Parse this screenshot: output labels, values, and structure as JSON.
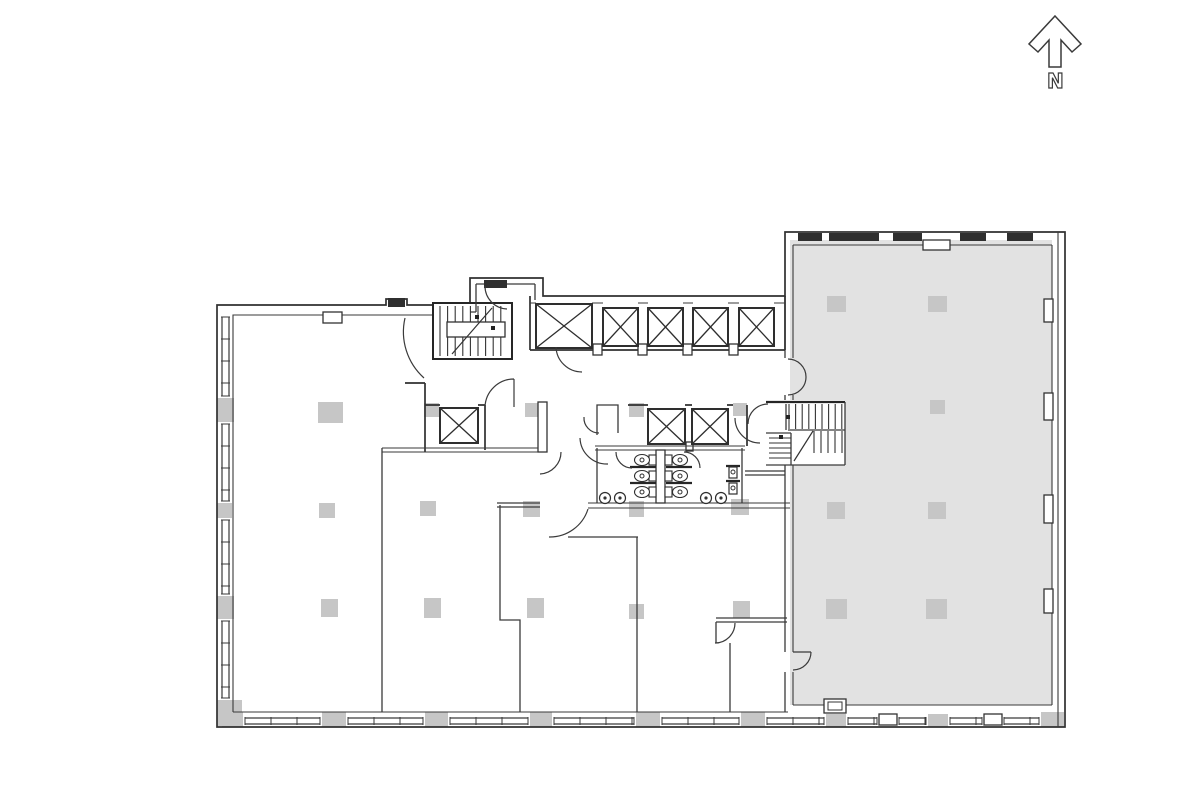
{
  "north_indicator": {
    "label": "N"
  },
  "colors": {
    "background": "#ffffff",
    "wall": "#2e2e2e",
    "wall_light": "#3a3a3a",
    "shaded_area_fill": "#e2e2e2",
    "column_fill": "#c6c6c6",
    "window_bar": "#2f2f2f"
  },
  "plan": {
    "shaded_area": {
      "name": "shaded-tenant-space"
    },
    "columns": [
      [
        217,
        398,
        17,
        24
      ],
      [
        217,
        503,
        15,
        15
      ],
      [
        217,
        596,
        17,
        23
      ],
      [
        217,
        700,
        25,
        26
      ],
      [
        318,
        402,
        25,
        21
      ],
      [
        319,
        503,
        16,
        15
      ],
      [
        321,
        599,
        17,
        18
      ],
      [
        420,
        501,
        16,
        15
      ],
      [
        424,
        598,
        17,
        20
      ],
      [
        523,
        501,
        17,
        16
      ],
      [
        527,
        598,
        17,
        20
      ],
      [
        424,
        403,
        15,
        14
      ],
      [
        525,
        403,
        15,
        14
      ],
      [
        629,
        403,
        15,
        14
      ],
      [
        733,
        403,
        14,
        13
      ],
      [
        629,
        501,
        15,
        16
      ],
      [
        731,
        499,
        18,
        16
      ],
      [
        629,
        604,
        15,
        15
      ],
      [
        733,
        601,
        17,
        17
      ],
      [
        827,
        296,
        19,
        16
      ],
      [
        928,
        296,
        19,
        16
      ],
      [
        830,
        400,
        15,
        14
      ],
      [
        930,
        400,
        15,
        14
      ],
      [
        827,
        502,
        18,
        17
      ],
      [
        928,
        502,
        18,
        17
      ],
      [
        826,
        599,
        21,
        20
      ],
      [
        926,
        599,
        21,
        20
      ],
      [
        222,
        712,
        21,
        15
      ],
      [
        322,
        712,
        24,
        15
      ],
      [
        425,
        712,
        23,
        15
      ],
      [
        530,
        712,
        22,
        15
      ],
      [
        636,
        712,
        24,
        15
      ],
      [
        741,
        712,
        24,
        15
      ],
      [
        826,
        714,
        20,
        13
      ],
      [
        928,
        714,
        20,
        13
      ],
      [
        1041,
        712,
        23,
        15
      ]
    ],
    "elevator_shafts": [
      [
        536,
        304,
        56,
        44
      ],
      [
        603,
        308,
        35,
        38
      ],
      [
        648,
        308,
        35,
        38
      ],
      [
        693,
        308,
        35,
        38
      ],
      [
        739,
        308,
        35,
        38
      ],
      [
        648,
        409,
        37,
        35
      ],
      [
        692,
        409,
        36,
        35
      ],
      [
        440,
        408,
        38,
        35
      ]
    ],
    "windows_left": [
      [
        222,
        317,
        396
      ],
      [
        222,
        424,
        501
      ],
      [
        222,
        520,
        594
      ],
      [
        222,
        621,
        698
      ]
    ],
    "windows_bottom": [
      [
        718,
        245,
        320
      ],
      [
        718,
        348,
        423
      ],
      [
        718,
        450,
        528
      ],
      [
        718,
        554,
        634
      ],
      [
        718,
        662,
        739
      ],
      [
        718,
        767,
        824
      ],
      [
        718,
        848,
        877
      ],
      [
        718,
        899,
        926
      ],
      [
        718,
        950,
        982
      ],
      [
        718,
        1004,
        1039
      ]
    ],
    "windows_top_gray": [
      [
        798,
        24
      ],
      [
        829,
        50
      ],
      [
        893,
        29
      ],
      [
        960,
        26
      ],
      [
        1007,
        26
      ]
    ],
    "stairs": {
      "flights": [
        {
          "dir": "v",
          "x1": 440,
          "x2": 508,
          "y1": 306,
          "y2": 356,
          "step": 7.6
        },
        {
          "dir": "v",
          "x1": 789,
          "x2": 842,
          "y1": 404,
          "y2": 429,
          "step": 6.6
        },
        {
          "dir": "v",
          "x1": 814,
          "x2": 842,
          "y1": 431,
          "y2": 453,
          "step": 7
        },
        {
          "dir": "h",
          "x1": 769,
          "x2": 791,
          "y1": 438,
          "y2": 462,
          "step": 5
        }
      ],
      "landings": [
        [
          447,
          322,
          58,
          15
        ]
      ],
      "diagonals": [
        [
          452,
          354,
          492,
          308
        ],
        [
          794,
          461,
          813,
          431
        ]
      ],
      "dots": [
        [
          477,
          317
        ],
        [
          493,
          328
        ],
        [
          788,
          417
        ],
        [
          781,
          437
        ]
      ]
    }
  }
}
